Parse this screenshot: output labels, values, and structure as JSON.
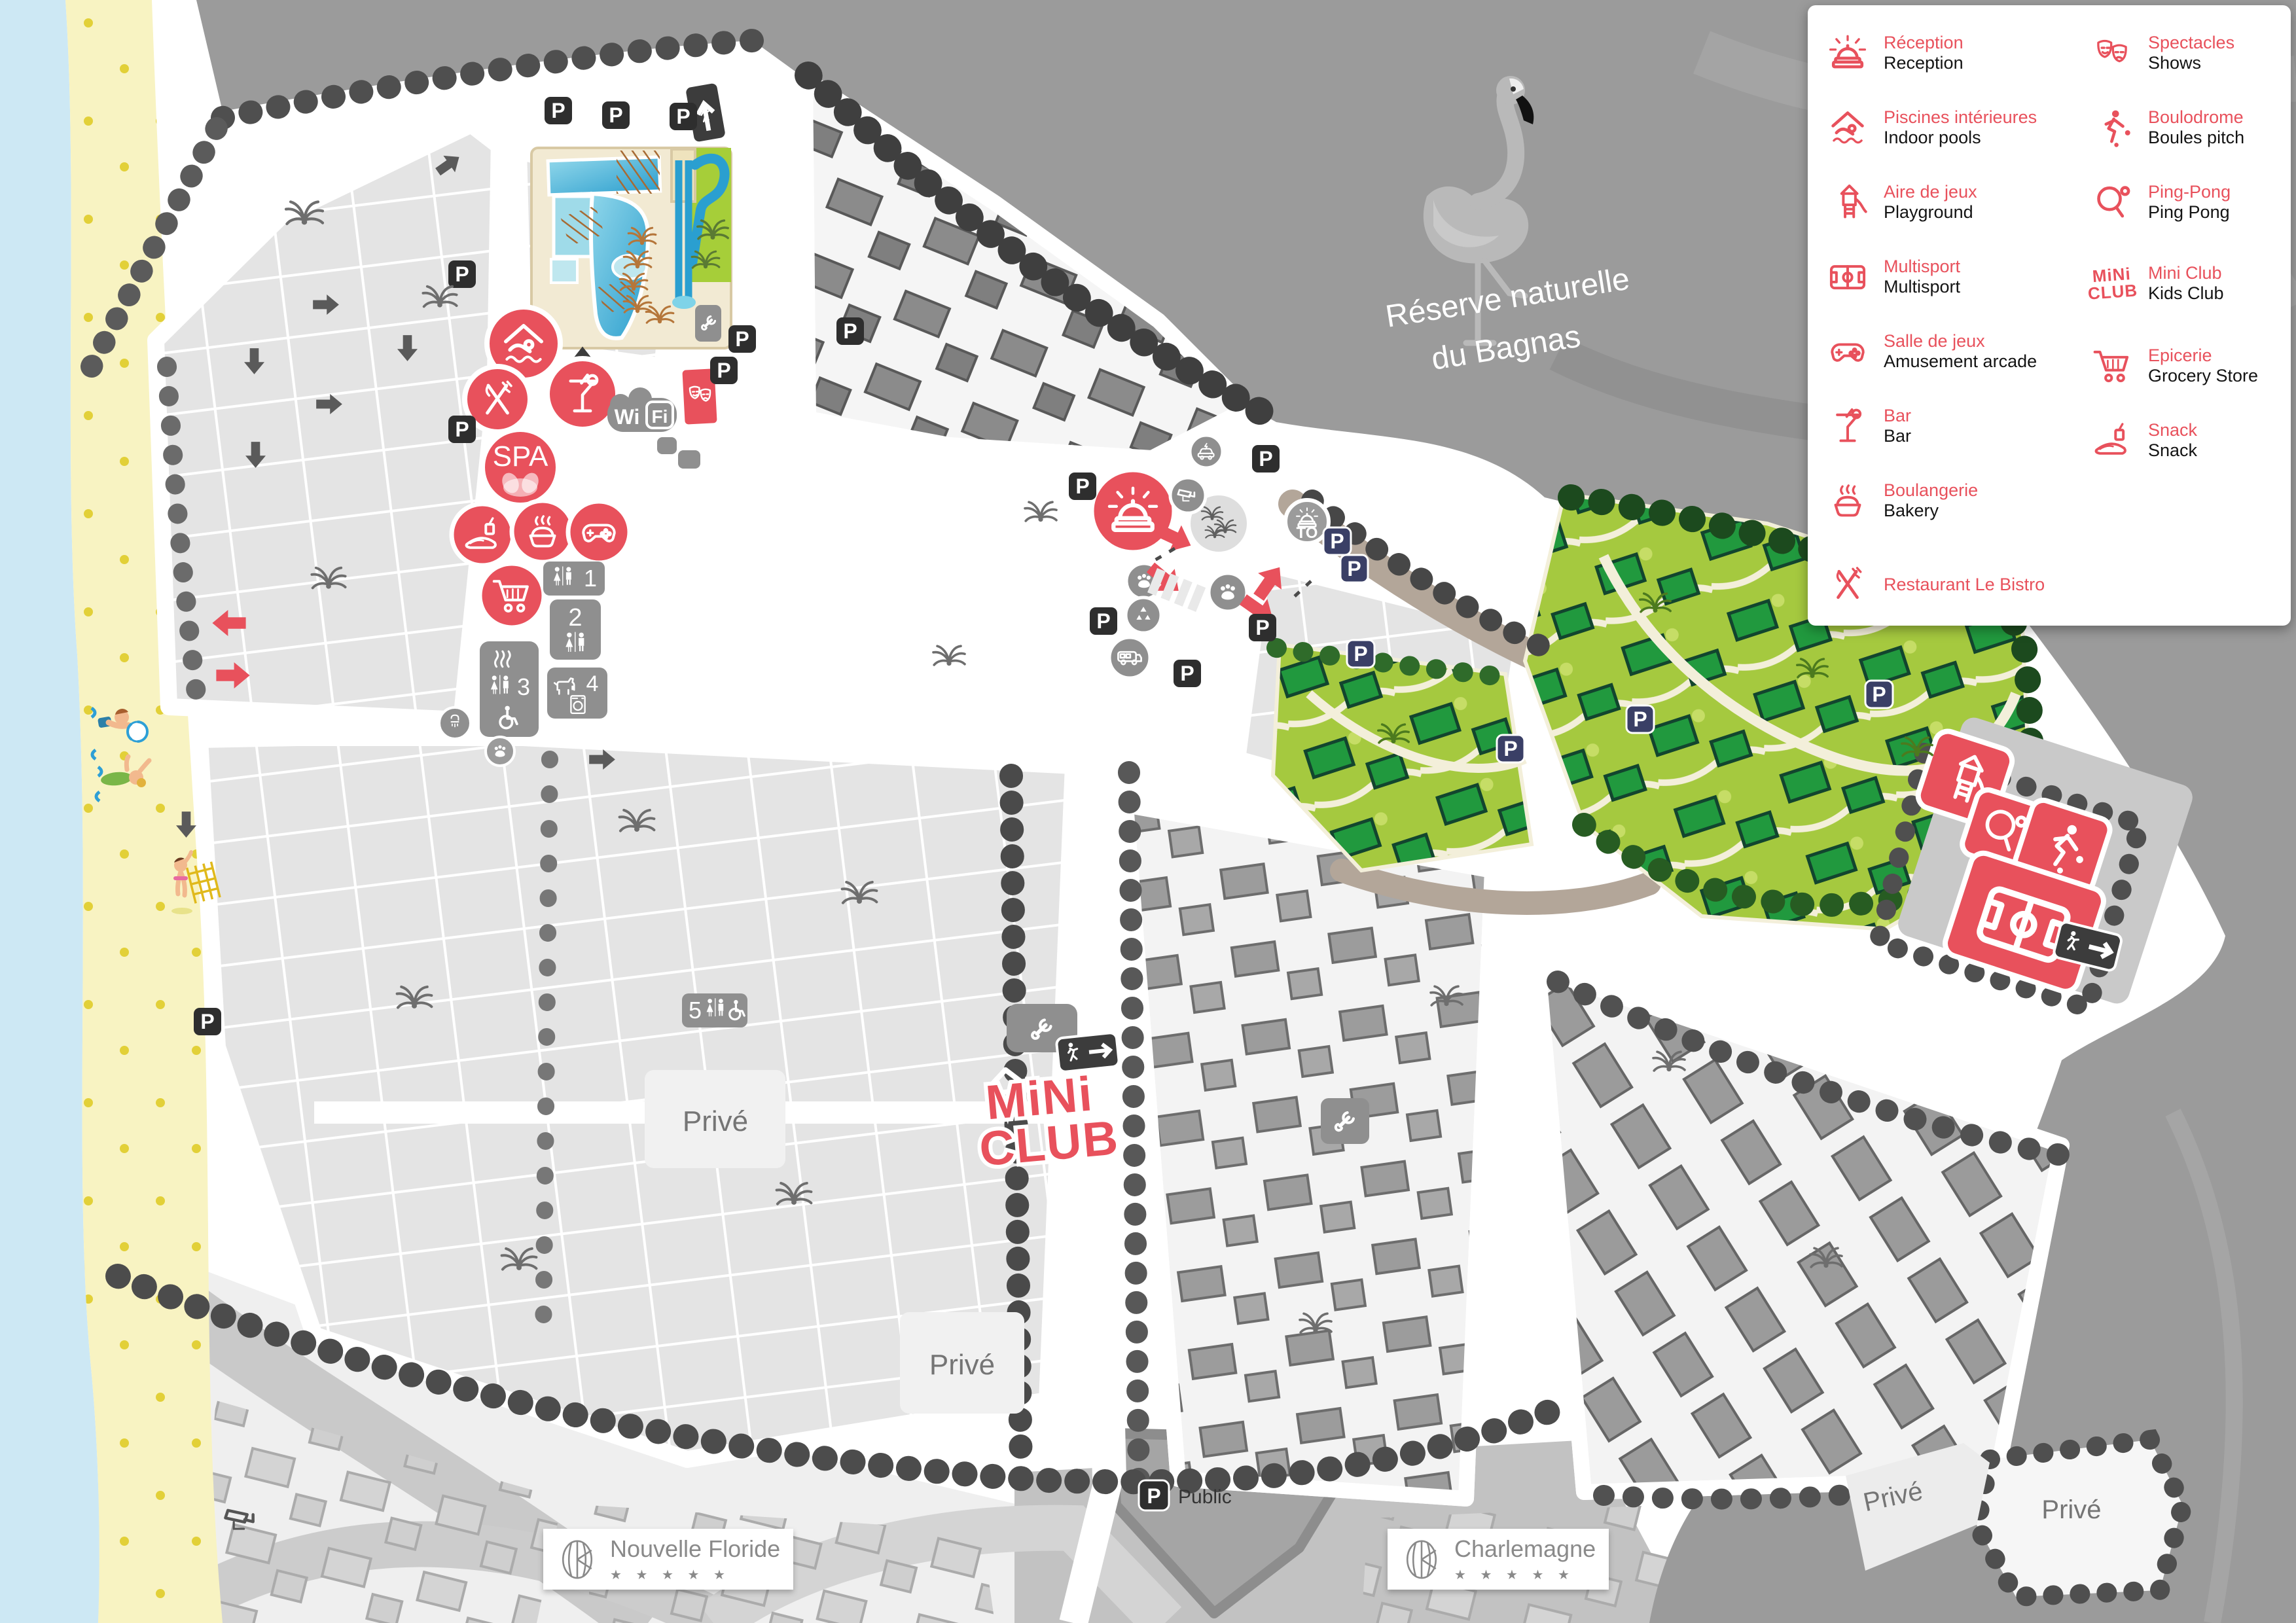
{
  "colors": {
    "accent_red": "#e8515c",
    "navy_parking": "#3a3f66",
    "black_parking": "#2e2e2e",
    "green_zone": "#a5c93f",
    "green_house": "#21993e",
    "sea": "#cde8f4",
    "sand": "#f8f3c2",
    "reserve_gray": "#9b9b9b",
    "taupe_road": "#b3a699"
  },
  "legend": {
    "items": [
      {
        "fr": "Réception",
        "en": "Reception",
        "icon": "reception-bell-icon"
      },
      {
        "fr": "Piscines intérieures",
        "en": "Indoor pools",
        "icon": "indoor-pool-icon"
      },
      {
        "fr": "Aire de jeux",
        "en": "Playground",
        "icon": "playground-icon"
      },
      {
        "fr": "Multisport",
        "en": "Multisport",
        "icon": "multisport-field-icon"
      },
      {
        "fr": "Salle de jeux",
        "en": "Amusement arcade",
        "icon": "game-controller-icon"
      },
      {
        "fr": "Bar",
        "en": "Bar",
        "icon": "cocktail-icon"
      },
      {
        "fr": "Boulangerie",
        "en": "Bakery",
        "icon": "bakery-pie-icon"
      },
      {
        "fr": "Restaurant Le Bistro",
        "en": "",
        "icon": "cutlery-icon"
      },
      {
        "fr": "Spectacles",
        "en": "Shows",
        "icon": "theater-masks-icon"
      },
      {
        "fr": "Boulodrome",
        "en": "Boules pitch",
        "icon": "boules-player-icon"
      },
      {
        "fr": "Ping-Pong",
        "en": "Ping Pong",
        "icon": "pingpong-paddle-icon"
      },
      {
        "fr": "Mini Club",
        "en": "Kids Club",
        "icon": "mini-club-logo"
      },
      {
        "fr": "Epicerie",
        "en": "Grocery Store",
        "icon": "shopping-cart-icon"
      },
      {
        "fr": "Snack",
        "en": "Snack",
        "icon": "snack-sandwich-icon"
      }
    ]
  },
  "map": {
    "reserve_label_line1": "Réserve naturelle",
    "reserve_label_line2": "du Bagnas",
    "parking_letter": "P",
    "public_label": "Public",
    "prive_label": "Privé",
    "spa_label": "SPA",
    "to_label": "TO",
    "wifi_wi": "Wi",
    "wifi_fi": "Fi",
    "mini_club_line1": "MiNi",
    "mini_club_line2": "CLUB",
    "sanitary_numbers": {
      "b1": "1",
      "b2": "2",
      "b3": "3",
      "b4": "4",
      "b5": "5"
    },
    "resorts": [
      {
        "name": "Nouvelle Floride",
        "stars": "★ ★ ★ ★ ★"
      },
      {
        "name": "Charlemagne",
        "stars": "★ ★ ★ ★ ★"
      }
    ]
  }
}
